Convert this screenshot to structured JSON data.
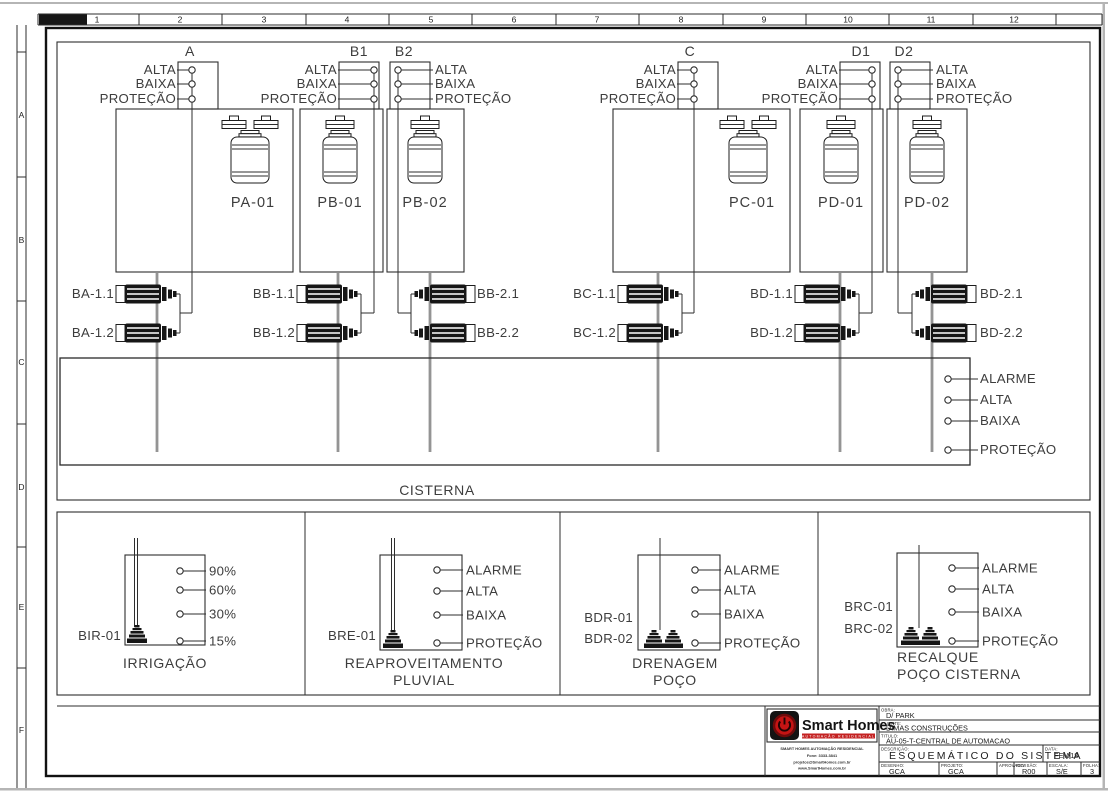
{
  "ruler": {
    "cols": [
      "1",
      "2",
      "3",
      "4",
      "5",
      "6",
      "7",
      "8",
      "9",
      "10",
      "11",
      "12"
    ],
    "rows": [
      "A",
      "B",
      "C",
      "D",
      "E",
      "F"
    ]
  },
  "terminal_groups": [
    {
      "label": "A",
      "ports": [
        "ALTA",
        "BAIXA",
        "PROTEÇÃO"
      ]
    },
    {
      "label": "B1",
      "ports": [
        "ALTA",
        "BAIXA",
        "PROTEÇÃO"
      ]
    },
    {
      "label": "B2",
      "ports": [
        "ALTA",
        "BAIXA",
        "PROTEÇÃO"
      ]
    },
    {
      "label": "C",
      "ports": [
        "ALTA",
        "BAIXA",
        "PROTEÇÃO"
      ]
    },
    {
      "label": "D1",
      "ports": [
        "ALTA",
        "BAIXA",
        "PROTEÇÃO"
      ]
    },
    {
      "label": "D2",
      "ports": [
        "ALTA",
        "BAIXA",
        "PROTEÇÃO"
      ]
    }
  ],
  "pumps": [
    {
      "label": "PA-01"
    },
    {
      "label": "PB-01"
    },
    {
      "label": "PB-02"
    },
    {
      "label": "PC-01"
    },
    {
      "label": "PD-01"
    },
    {
      "label": "PD-02"
    }
  ],
  "valves": [
    {
      "a": "BA-1.1",
      "b": "BA-1.2"
    },
    {
      "a": "BB-1.1",
      "b": "BB-1.2"
    },
    {
      "a": "BB-2.1",
      "b": "BB-2.2"
    },
    {
      "a": "BC-1.1",
      "b": "BC-1.2"
    },
    {
      "a": "BD-1.1",
      "b": "BD-1.2"
    },
    {
      "a": "BD-2.1",
      "b": "BD-2.2"
    }
  ],
  "cistern": {
    "title": "CISTERNA",
    "ports": [
      "ALARME",
      "ALTA",
      "BAIXA",
      "PROTEÇÃO"
    ]
  },
  "panels": [
    {
      "device1": "BIR-01",
      "device2": "",
      "ports": [
        "90%",
        "60%",
        "30%",
        "15%"
      ],
      "line1": "IRRIGAÇÃO",
      "line2": ""
    },
    {
      "device1": "BRE-01",
      "device2": "",
      "ports": [
        "ALARME",
        "ALTA",
        "BAIXA",
        "PROTEÇÃO"
      ],
      "line1": "REAPROVEITAMENTO",
      "line2": "PLUVIAL"
    },
    {
      "device1": "BDR-01",
      "device2": "BDR-02",
      "ports": [
        "ALARME",
        "ALTA",
        "BAIXA",
        "PROTEÇÃO"
      ],
      "line1": "DRENAGEM",
      "line2": "POÇO"
    },
    {
      "device1": "BRC-01",
      "device2": "BRC-02",
      "ports": [
        "ALARME",
        "ALTA",
        "BAIXA",
        "PROTEÇÃO"
      ],
      "line1": "RECALQUE",
      "line2": "POÇO CISTERNA"
    }
  ],
  "title_block": {
    "brand": "Smart Homes",
    "tagline": "AUTOMAÇÃO RESIDENCIAL",
    "company_lines": [
      "SMART HOMES AUTOMAÇÃO RESIDENCIAL",
      "Fone: 3333-3841",
      "projetos@SmartHomes.com.br",
      "www.SmartHomes.com.br"
    ],
    "fields": {
      "obra_label": "OBRA:",
      "obra": "D/ PARK",
      "cliente_label": "CLIENTE:",
      "cliente": "DIMAS CONSTRUÇÕES",
      "titulo_label": "TITULO:",
      "titulo": "AU-05-T-CENTRAL DE AUTOMACAO",
      "descricao_label": "DESCRIÇÃO:",
      "descricao": "ESQUEMÁTICO DO SISTEMA",
      "data_label": "DATA:",
      "data": "FEV/18",
      "desenho_label": "DESENHO:",
      "desenho": "GCA",
      "projeto_label": "PROJETO:",
      "projeto": "GCA",
      "aprovado_label": "APROVADO:",
      "aprovado": "",
      "revisao_label": "REVISÃO:",
      "revisao": "R00",
      "escala_label": "ESCALA:",
      "escala": "S/E",
      "folha_label": "FOLHA:",
      "folha": "3"
    }
  }
}
